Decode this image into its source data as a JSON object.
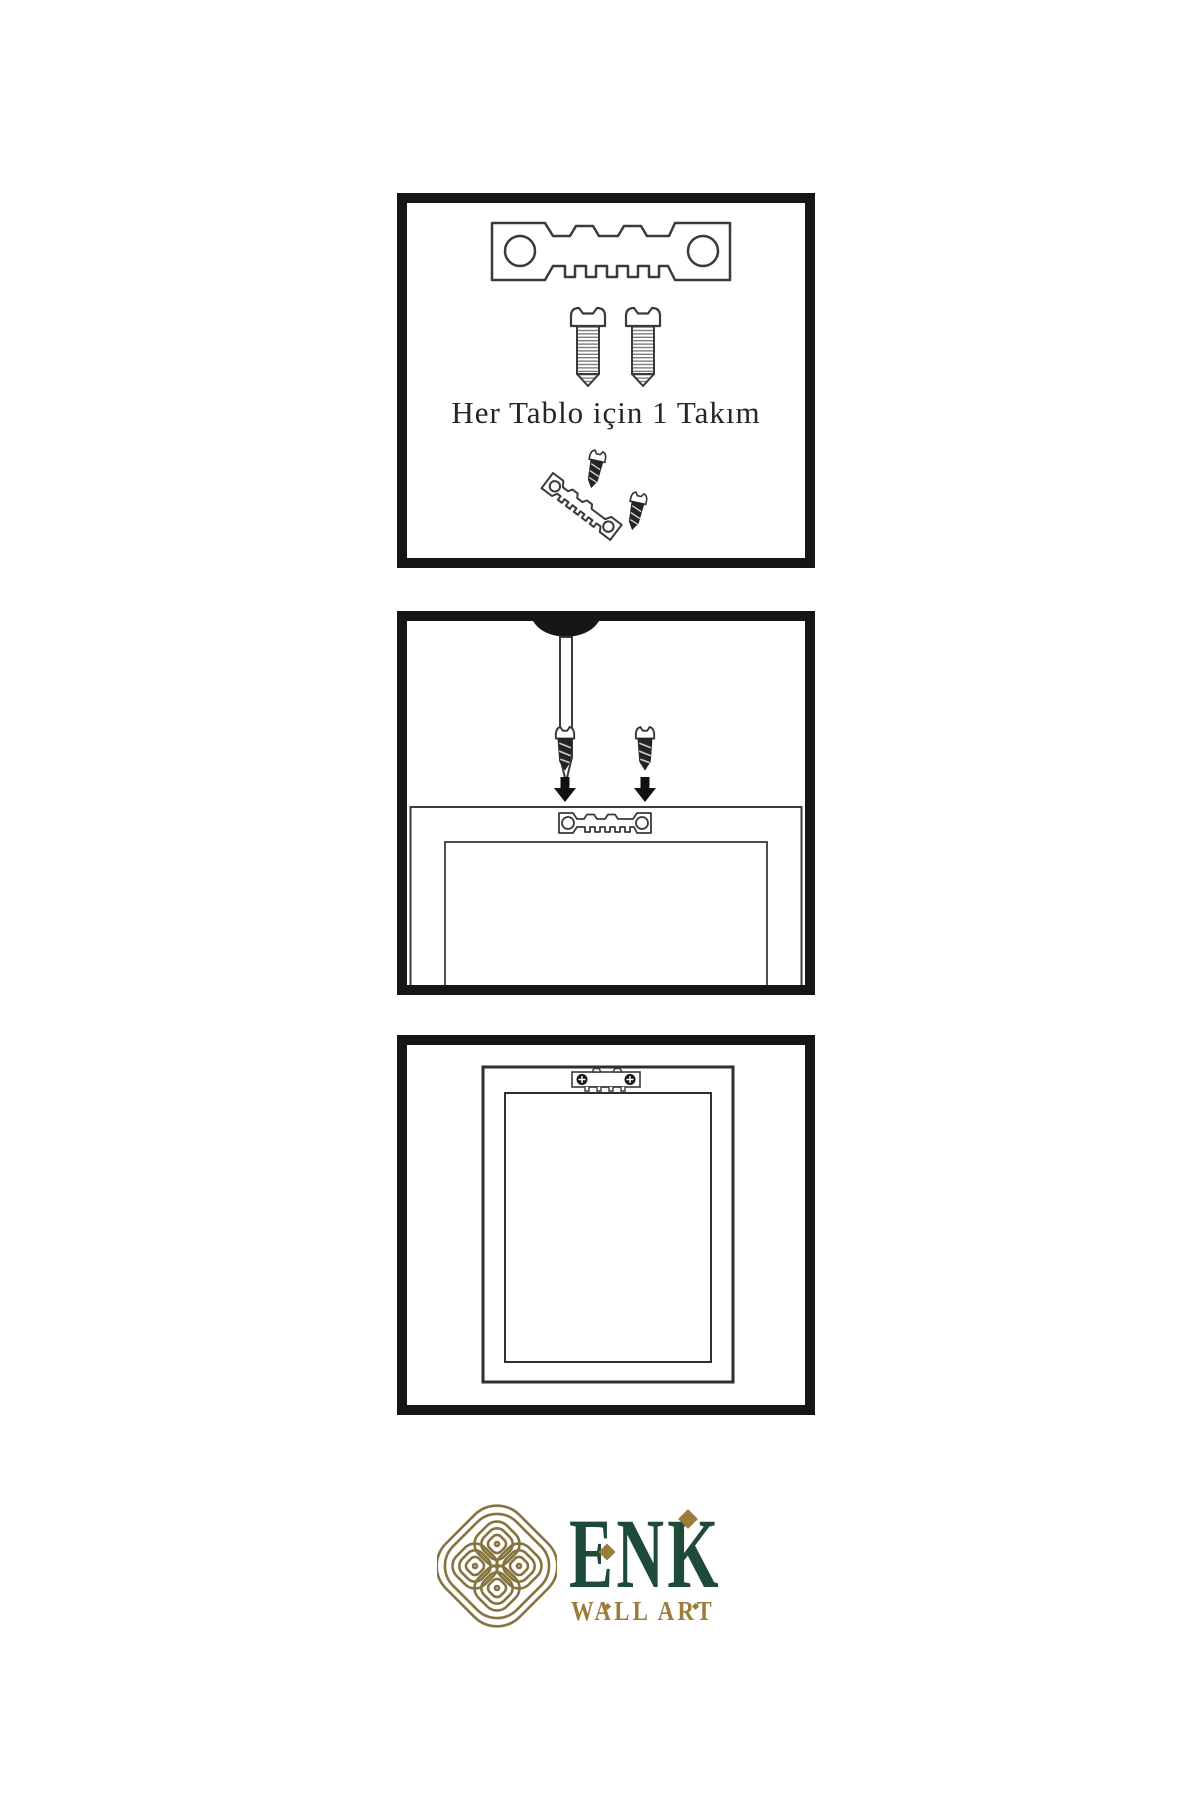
{
  "colors": {
    "background": "#ffffff",
    "panel_border": "#161616",
    "line": "#3a3a3a",
    "dark_part": "#242424",
    "brand_green": "#1e4a3a",
    "brand_gold": "#9b7c3c",
    "knot_gold": "#857440",
    "caption_text": "#262626"
  },
  "steps": [
    {
      "name": "hardware-set",
      "caption": "Her Tablo için 1 Takım",
      "parts": [
        "sawtooth-hanger",
        "screw",
        "screw",
        "screw-and-tilted-hanger-assembly"
      ]
    },
    {
      "name": "mount-hardware",
      "parts": [
        "wall-nail",
        "dark-screw",
        "dark-screw",
        "down-arrow",
        "down-arrow",
        "frame-back-with-sawtooth-hanger"
      ]
    },
    {
      "name": "hang-frame",
      "parts": [
        "hanging-frame-with-mounted-sawtooth-hanger"
      ]
    }
  ],
  "logo": {
    "icon": "interlaced-knot",
    "brand": "ENK",
    "subtitle": "WALL ART"
  }
}
